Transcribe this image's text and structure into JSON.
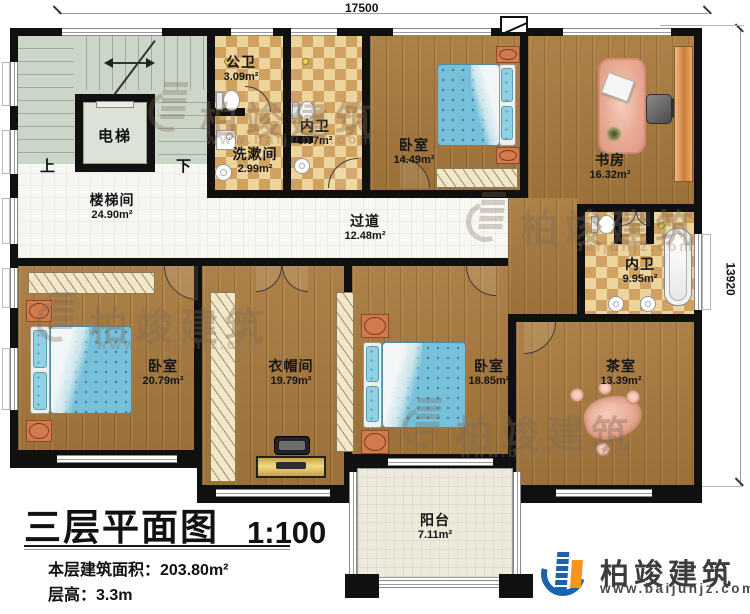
{
  "title_block": {
    "title": "三层平面图",
    "scale": "1:100",
    "floor_area": "本层建筑面积：203.80m²",
    "floor_height": "层高：3.3m"
  },
  "dimensions": {
    "top": "17500",
    "right": "13920"
  },
  "stair": {
    "elevator": "电梯",
    "up": "上",
    "down": "下"
  },
  "rooms": [
    {
      "name": "楼梯间",
      "area": "24.90m²"
    },
    {
      "name": "公卫",
      "area": "3.09m²"
    },
    {
      "name": "洗漱间",
      "area": "2.99m²"
    },
    {
      "name": "内卫",
      "area": "6.07m²"
    },
    {
      "name": "卧室",
      "area": "14.49m²"
    },
    {
      "name": "书房",
      "area": "16.32m²"
    },
    {
      "name": "过道",
      "area": "12.48m²"
    },
    {
      "name": "内卫",
      "area": "9.95m²"
    },
    {
      "name": "卧室",
      "area": "20.79m²"
    },
    {
      "name": "衣帽间",
      "area": "19.79m²"
    },
    {
      "name": "卧室",
      "area": "18.85m²"
    },
    {
      "name": "茶室",
      "area": "13.39m²"
    },
    {
      "name": "阳台",
      "area": "7.11m²"
    }
  ],
  "watermark": {
    "brand": "柏竣建筑",
    "website": "www.baijunjz.com"
  },
  "logo": {
    "brand": "柏竣建筑",
    "website": "www.baijunjz.com"
  },
  "colors": {
    "wall": "#101010",
    "wood": "#a87a3e",
    "bath_tile": "#cfa261",
    "stair": "#cbd5c8",
    "bed": "#76c0d9",
    "logo_blue": "#1c63ad",
    "logo_orange": "#f7941d"
  }
}
